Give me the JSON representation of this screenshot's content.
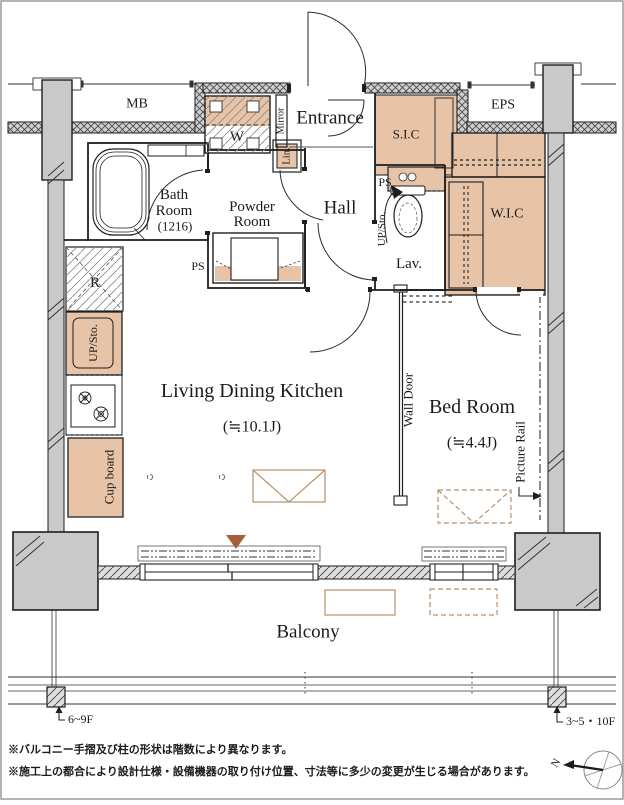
{
  "plan_title": "apartment floor plan",
  "rooms": {
    "mb": "MB",
    "eps": "EPS",
    "entrance": "Entrance",
    "sic": "S.I.C",
    "wic": "W.I.C",
    "bath1": "Bath",
    "bath2": "Room",
    "bath3": "(1216)",
    "powder1": "Powder",
    "powder2": "Room",
    "hall": "Hall",
    "lav": "Lav.",
    "ldk1": "Living Dining Kitchen",
    "ldk2": "(≒10.1J)",
    "bed1": "Bed Room",
    "bed2": "(≒4.4J)",
    "balcony": "Balcony"
  },
  "fixtures": {
    "washer": "W",
    "mirror": "Mirror",
    "linen": "Lin.",
    "ps": "PS",
    "up_sto": "UP/Sto.",
    "fridge": "R",
    "cupboard": "Cup board",
    "wall_door": "Wall Door",
    "picture_rail": "Picture Rail"
  },
  "annotations": {
    "floors_left": "6~9F",
    "floors_right": "3~5・10F",
    "north": "N",
    "note1": "※バルコニー手摺及び柱の形状は階数により異なります。",
    "note2": "※施工上の都合により設計仕様・設備機器の取り付け位置、寸法等に多少の変更が生じる場合があります。"
  },
  "colors": {
    "fixture_fill": "#e7c3a7",
    "column_fill": "#c9c9c9",
    "furniture_outline": "#b9906a",
    "marker_brown": "#a5603a",
    "wall_black": "#1e1e1e"
  }
}
